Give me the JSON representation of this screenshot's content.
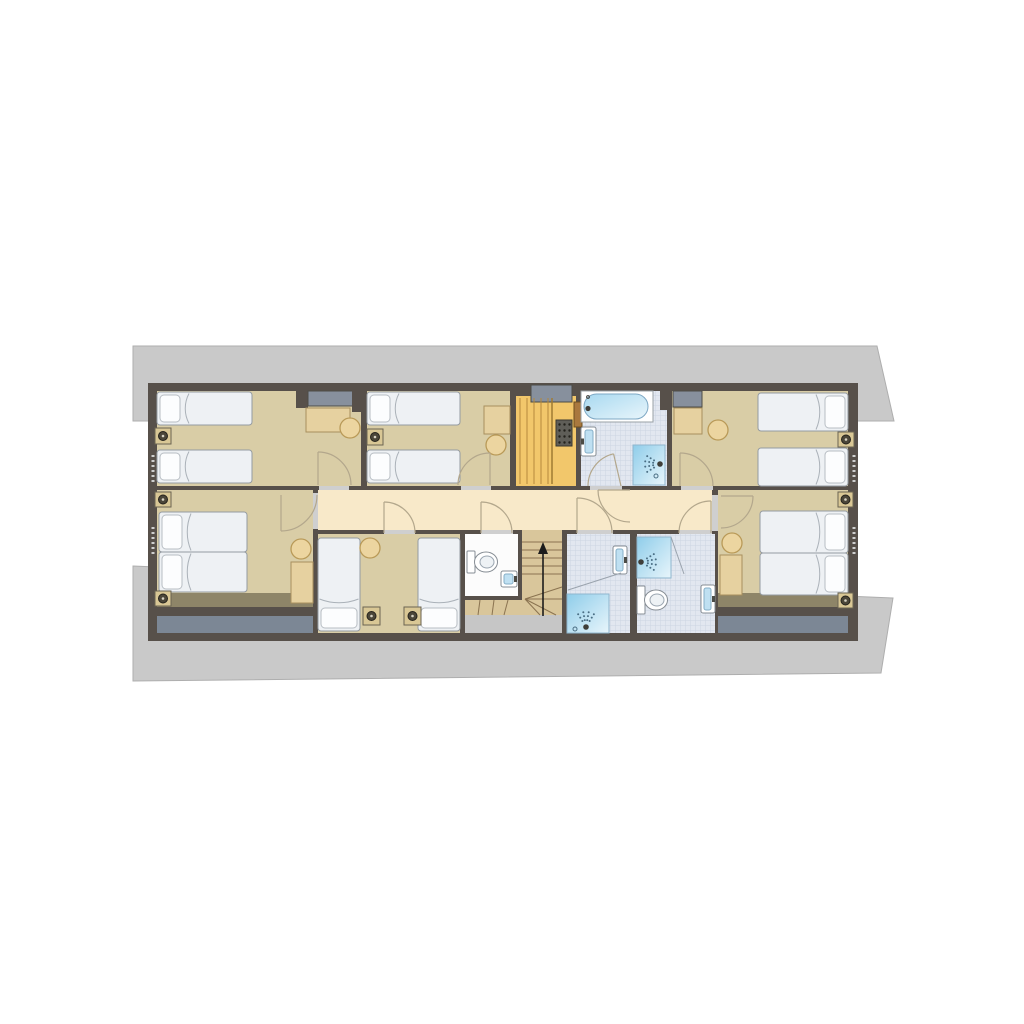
{
  "meta": {
    "kind": "architectural-floor-plan",
    "canvas_w": 1024,
    "canvas_h": 1024,
    "background": "#ffffff"
  },
  "palette": {
    "wall": "#57504a",
    "bedroom_floor": "#d9cda6",
    "corridor_floor": "#f8e9c9",
    "bath_tile_base": "#e2e7f0",
    "bath_tile_line": "#ccd4e2",
    "sauna": "#f2c76b",
    "stair_wood": "#d9c69b",
    "stair_line": "#8a7350",
    "roof": "#c9c9c9",
    "eaves_slate": "#7c8795",
    "eaves_olive": "#8e8568",
    "door_arc": "#b3a78c",
    "shower_blue": "#8fcdea",
    "fixture_white": "#ffffff"
  },
  "elements": [
    {
      "n": "roof-outline-upper",
      "t": "poly",
      "pts": "133,346 877,346 894,421 133,421",
      "f": "#c9c9c9",
      "s": "#aeaeae"
    },
    {
      "n": "roof-outline-lower",
      "t": "poly",
      "pts": "133,566 893,598 881,673 133,681",
      "f": "#c9c9c9",
      "s": "#aeaeae"
    },
    {
      "n": "building-walls",
      "t": "rect",
      "x": 148,
      "y": 383,
      "w": 710,
      "h": 258,
      "f": "#57504a"
    },
    {
      "n": "bedroom-1-floor",
      "t": "rect",
      "x": 157,
      "y": 391,
      "w": 204,
      "h": 95,
      "f": "#d9cda6"
    },
    {
      "n": "bedroom-2-floor",
      "t": "rect",
      "x": 367,
      "y": 391,
      "w": 143,
      "h": 95,
      "f": "#d9cda6"
    },
    {
      "n": "sauna-floor",
      "t": "rect",
      "x": 516,
      "y": 396,
      "w": 60,
      "h": 90,
      "f": "#f2c76b"
    },
    {
      "n": "bathroom-top-floor",
      "t": "rect",
      "x": 581,
      "y": 391,
      "w": 86,
      "h": 95,
      "f": "tile"
    },
    {
      "n": "bedroom-3-floor",
      "t": "rect",
      "x": 672,
      "y": 391,
      "w": 176,
      "h": 95,
      "f": "#d9cda6"
    },
    {
      "n": "corridor-floor",
      "t": "rect",
      "x": 318,
      "y": 490,
      "w": 394,
      "h": 40,
      "f": "#f8e9c9"
    },
    {
      "n": "bedroom-4-floor",
      "t": "rect",
      "x": 157,
      "y": 490,
      "w": 156,
      "h": 103,
      "f": "#d9cda6"
    },
    {
      "n": "eaves-olive-left",
      "t": "rect",
      "x": 157,
      "y": 593,
      "w": 156,
      "h": 14,
      "f": "#8e8568"
    },
    {
      "n": "eaves-slate-left",
      "t": "rect",
      "x": 157,
      "y": 616,
      "w": 156,
      "h": 17,
      "f": "#7c8795"
    },
    {
      "n": "bedroom-5-floor",
      "t": "rect",
      "x": 318,
      "y": 534,
      "w": 142,
      "h": 99,
      "f": "#d9cda6"
    },
    {
      "n": "wc-floor",
      "t": "rect",
      "x": 465,
      "y": 534,
      "w": 53,
      "h": 62,
      "f": "#fcfcfc"
    },
    {
      "n": "stair-flight",
      "t": "rect",
      "x": 522,
      "y": 534,
      "w": 40,
      "h": 66,
      "f": "#d9c69b"
    },
    {
      "n": "stair-winders",
      "t": "poly",
      "pts": "522,583 562,583 562,615 465,615 465,600 522,600",
      "f": "#d9c69b"
    },
    {
      "n": "under-stair-void",
      "t": "rect",
      "x": 465,
      "y": 615,
      "w": 97,
      "h": 18,
      "f": "#c6c6c6"
    },
    {
      "n": "bathroom-left-floor",
      "t": "rect",
      "x": 567,
      "y": 534,
      "w": 63,
      "h": 99,
      "f": "tile"
    },
    {
      "n": "bathroom-right-floor",
      "t": "rect",
      "x": 637,
      "y": 534,
      "w": 78,
      "h": 99,
      "f": "tile"
    },
    {
      "n": "bedroom-6-floor",
      "t": "rect",
      "x": 718,
      "y": 490,
      "w": 130,
      "h": 103,
      "f": "#d9cda6"
    },
    {
      "n": "eaves-olive-right",
      "t": "rect",
      "x": 718,
      "y": 593,
      "w": 130,
      "h": 14,
      "f": "#8e8568"
    },
    {
      "n": "eaves-slate-right",
      "t": "rect",
      "x": 718,
      "y": 616,
      "w": 130,
      "h": 17,
      "f": "#7c8795"
    },
    {
      "n": "wall-stub-a",
      "t": "rect",
      "x": 296,
      "y": 383,
      "w": 12,
      "h": 25,
      "f": "#57504a"
    },
    {
      "n": "duct-bedroom-1",
      "t": "rect",
      "x": 308,
      "y": 391,
      "w": 48,
      "h": 15,
      "f": "#87909d",
      "s": "#4c4c46"
    },
    {
      "n": "wall-stub-b",
      "t": "rect",
      "x": 352,
      "y": 383,
      "w": 14,
      "h": 29,
      "f": "#57504a"
    },
    {
      "n": "duct-sauna",
      "t": "rect",
      "x": 531,
      "y": 385,
      "w": 41,
      "h": 17,
      "f": "#87909d",
      "s": "#4c4c46"
    },
    {
      "n": "wall-stub-c",
      "t": "rect",
      "x": 660,
      "y": 383,
      "w": 12,
      "h": 27,
      "f": "#57504a"
    },
    {
      "n": "duct-bedroom-3",
      "t": "rect",
      "x": 673,
      "y": 391,
      "w": 29,
      "h": 16,
      "f": "#87909d",
      "s": "#4c4c46"
    },
    {
      "n": "threshold-bedroom-1",
      "t": "rect",
      "x": 319,
      "y": 486,
      "w": 30,
      "h": 4,
      "f": "#cfcfcf"
    },
    {
      "n": "threshold-bedroom-2",
      "t": "rect",
      "x": 461,
      "y": 486,
      "w": 30,
      "h": 4,
      "f": "#cfcfcf"
    },
    {
      "n": "threshold-bathroom-top",
      "t": "rect",
      "x": 590,
      "y": 486,
      "w": 32,
      "h": 4,
      "f": "#cfcfcf"
    },
    {
      "n": "threshold-bedroom-3",
      "t": "rect",
      "x": 681,
      "y": 486,
      "w": 32,
      "h": 4,
      "f": "#cfcfcf"
    },
    {
      "n": "threshold-bedroom-4",
      "t": "rect",
      "x": 313,
      "y": 493,
      "w": 5,
      "h": 36,
      "f": "#cfcfcf"
    },
    {
      "n": "threshold-bedroom-5",
      "t": "rect",
      "x": 384,
      "y": 530,
      "w": 31,
      "h": 4,
      "f": "#cfcfcf"
    },
    {
      "n": "threshold-wc",
      "t": "rect",
      "x": 481,
      "y": 530,
      "w": 32,
      "h": 4,
      "f": "#cfcfcf"
    },
    {
      "n": "threshold-bathroom-left",
      "t": "rect",
      "x": 577,
      "y": 530,
      "w": 36,
      "h": 4,
      "f": "#cfcfcf"
    },
    {
      "n": "threshold-bathroom-right",
      "t": "rect",
      "x": 679,
      "y": 530,
      "w": 33,
      "h": 4,
      "f": "#cfcfcf"
    },
    {
      "n": "threshold-bedroom-6",
      "t": "rect",
      "x": 712,
      "y": 495,
      "w": 6,
      "h": 36,
      "f": "#cfcfcf"
    },
    {
      "n": "threshold-stairs",
      "t": "rect",
      "x": 522,
      "y": 530,
      "w": 40,
      "h": 4,
      "f": "#d9c69b"
    },
    {
      "n": "sauna-bench-slat",
      "t": "line",
      "x1": 520,
      "y1": 398,
      "x2": 520,
      "y2": 484,
      "s": "#b5893c",
      "w": 1
    },
    {
      "n": "sauna-bench-slat",
      "t": "line",
      "x1": 527,
      "y1": 398,
      "x2": 527,
      "y2": 484,
      "s": "#b5893c",
      "w": 1
    },
    {
      "n": "sauna-bench-slat",
      "t": "line",
      "x1": 534,
      "y1": 398,
      "x2": 534,
      "y2": 484,
      "s": "#b5893c",
      "w": 1
    },
    {
      "n": "sauna-bench-slat",
      "t": "line",
      "x1": 541,
      "y1": 398,
      "x2": 541,
      "y2": 484,
      "s": "#b5893c",
      "w": 1
    },
    {
      "n": "sauna-bench-slat",
      "t": "line",
      "x1": 548,
      "y1": 398,
      "x2": 548,
      "y2": 484,
      "s": "#b5893c",
      "w": 1
    },
    {
      "n": "sauna-bench-edge",
      "t": "line",
      "x1": 552,
      "y1": 398,
      "x2": 552,
      "y2": 484,
      "s": "#a07a33",
      "w": 1.5
    },
    {
      "n": "sauna-heater",
      "t": "rect",
      "x": 556,
      "y": 420,
      "w": 16,
      "h": 26,
      "f": "#5f5e58",
      "s": "#38372f"
    },
    {
      "n": "sauna-heater-stones",
      "t": "dotgrid",
      "x": 559.5,
      "y": 424.5,
      "cols": 3,
      "rows": 4,
      "dx": 5,
      "dy": 6,
      "r": 1.2,
      "f": "#23221c"
    },
    {
      "n": "sauna-door",
      "t": "rect",
      "x": 574,
      "y": 402,
      "w": 8,
      "h": 25,
      "f": "#a9783e",
      "s": "#70501f"
    },
    {
      "n": "stair-tread",
      "t": "line",
      "x1": 522,
      "y1": 542,
      "x2": 562,
      "y2": 542,
      "s": "#8a7350",
      "w": 1
    },
    {
      "n": "stair-tread",
      "t": "line",
      "x1": 522,
      "y1": 550,
      "x2": 562,
      "y2": 550,
      "s": "#8a7350",
      "w": 1
    },
    {
      "n": "stair-tread",
      "t": "line",
      "x1": 522,
      "y1": 558,
      "x2": 562,
      "y2": 558,
      "s": "#8a7350",
      "w": 1
    },
    {
      "n": "stair-tread",
      "t": "line",
      "x1": 522,
      "y1": 566,
      "x2": 562,
      "y2": 566,
      "s": "#8a7350",
      "w": 1
    },
    {
      "n": "stair-tread",
      "t": "line",
      "x1": 522,
      "y1": 574,
      "x2": 562,
      "y2": 574,
      "s": "#8a7350",
      "w": 1
    },
    {
      "n": "stair-winder-line",
      "t": "line",
      "x1": 525,
      "y1": 599,
      "x2": 562,
      "y2": 587,
      "s": "#8a7350",
      "w": 1
    },
    {
      "n": "stair-winder-line",
      "t": "line",
      "x1": 525,
      "y1": 599,
      "x2": 562,
      "y2": 599,
      "s": "#8a7350",
      "w": 1
    },
    {
      "n": "stair-winder-line",
      "t": "line",
      "x1": 525,
      "y1": 599,
      "x2": 556,
      "y2": 615,
      "s": "#8a7350",
      "w": 1
    },
    {
      "n": "stair-winder-line",
      "t": "line",
      "x1": 525,
      "y1": 599,
      "x2": 540,
      "y2": 615,
      "s": "#8a7350",
      "w": 1
    },
    {
      "n": "stair-winder-line",
      "t": "line",
      "x1": 508,
      "y1": 600,
      "x2": 504,
      "y2": 615,
      "s": "#8a7350",
      "w": 1
    },
    {
      "n": "stair-winder-line",
      "t": "line",
      "x1": 494,
      "y1": 600,
      "x2": 492,
      "y2": 615,
      "s": "#8a7350",
      "w": 1
    },
    {
      "n": "stair-winder-line",
      "t": "line",
      "x1": 480,
      "y1": 600,
      "x2": 478,
      "y2": 615,
      "s": "#8a7350",
      "w": 1
    },
    {
      "n": "stair-up-arrow-shaft",
      "t": "line",
      "x1": 543,
      "y1": 616,
      "x2": 543,
      "y2": 552,
      "s": "#1c1c1c",
      "w": 1.6
    },
    {
      "n": "stair-up-arrow-head",
      "t": "poly",
      "pts": "543,542 538,554 548,554",
      "f": "#1c1c1c"
    },
    {
      "n": "bathtub",
      "t": "tub",
      "x": 581,
      "y": 391,
      "w": 72,
      "h": 31
    },
    {
      "n": "sink-bathroom-top",
      "t": "sink",
      "x": 581,
      "y": 427,
      "w": 15,
      "h": 29,
      "side": "left"
    },
    {
      "n": "shower-bathroom-top",
      "t": "shower",
      "x": 633,
      "y": 445,
      "w": 32,
      "h": 40,
      "hx": 660,
      "hy": 464,
      "dx": -1,
      "dy": 0
    },
    {
      "n": "drain-bathroom-top",
      "t": "circle",
      "cx": 656,
      "cy": 476,
      "r": 2,
      "f": "none",
      "s": "#4a6e84"
    },
    {
      "n": "sink-bathroom-left",
      "t": "sink",
      "x": 613,
      "y": 546,
      "w": 14,
      "h": 28,
      "side": "right"
    },
    {
      "n": "shower-bathroom-left",
      "t": "shower",
      "x": 567,
      "y": 594,
      "w": 42,
      "h": 39,
      "hx": 586,
      "hy": 627,
      "dx": 0,
      "dy": -1
    },
    {
      "n": "headroom-line-left",
      "t": "line",
      "x1": 568,
      "y1": 590,
      "x2": 621,
      "y2": 573,
      "s": "#9aa3ad",
      "w": 1
    },
    {
      "n": "drain-bathroom-left",
      "t": "circle",
      "cx": 575,
      "cy": 629,
      "r": 2,
      "f": "none",
      "s": "#4a6e84"
    },
    {
      "n": "shower-bathroom-right",
      "t": "shower",
      "x": 637,
      "y": 537,
      "w": 34,
      "h": 41,
      "hx": 641,
      "hy": 562,
      "dx": 1,
      "dy": 0
    },
    {
      "n": "headroom-line-right",
      "t": "line",
      "x1": 671,
      "y1": 537,
      "x2": 684,
      "y2": 574,
      "s": "#9aa3ad",
      "w": 1
    },
    {
      "n": "toilet-bathroom-right",
      "t": "toilet",
      "x": 637,
      "y": 586,
      "th": 28
    },
    {
      "n": "sink-bathroom-right",
      "t": "sink",
      "x": 701,
      "y": 585,
      "w": 14,
      "h": 28,
      "side": "right"
    },
    {
      "n": "toilet-wc",
      "t": "toilet",
      "x": 467,
      "y": 551,
      "th": 22
    },
    {
      "n": "sink-wc",
      "t": "sink",
      "x": 501,
      "y": 571,
      "w": 16,
      "h": 16,
      "side": "right"
    },
    {
      "n": "desk-bedroom-1",
      "t": "rect",
      "x": 306,
      "y": 408,
      "w": 44,
      "h": 24,
      "f": "#e6d1a0",
      "s": "#a8905e"
    },
    {
      "n": "desk-bedroom-2",
      "t": "rect",
      "x": 484,
      "y": 406,
      "w": 26,
      "h": 28,
      "f": "#e6d1a0",
      "s": "#a8905e"
    },
    {
      "n": "desk-bedroom-3",
      "t": "rect",
      "x": 674,
      "y": 408,
      "w": 28,
      "h": 26,
      "f": "#e6d1a0",
      "s": "#a8905e"
    },
    {
      "n": "desk-bedroom-4",
      "t": "rect",
      "x": 291,
      "y": 562,
      "w": 22,
      "h": 41,
      "f": "#e6d1a0",
      "s": "#a8905e"
    },
    {
      "n": "desk-bedroom-6",
      "t": "rect",
      "x": 720,
      "y": 555,
      "w": 22,
      "h": 40,
      "f": "#e6d1a0",
      "s": "#a8905e"
    },
    {
      "n": "bed-single",
      "t": "bed",
      "x": 157,
      "y": 392,
      "w": 95,
      "h": 33,
      "dir": "left"
    },
    {
      "n": "bed-single",
      "t": "bed",
      "x": 157,
      "y": 450,
      "w": 95,
      "h": 33,
      "dir": "left"
    },
    {
      "n": "bed-single",
      "t": "bed",
      "x": 367,
      "y": 392,
      "w": 93,
      "h": 33,
      "dir": "left"
    },
    {
      "n": "bed-single",
      "t": "bed",
      "x": 367,
      "y": 450,
      "w": 93,
      "h": 33,
      "dir": "left"
    },
    {
      "n": "bed-single",
      "t": "bed",
      "x": 758,
      "y": 393,
      "w": 90,
      "h": 38,
      "dir": "right"
    },
    {
      "n": "bed-single",
      "t": "bed",
      "x": 758,
      "y": 448,
      "w": 90,
      "h": 38,
      "dir": "right"
    },
    {
      "n": "bed-double-half",
      "t": "bed",
      "x": 159,
      "y": 512,
      "w": 88,
      "h": 40,
      "dir": "left"
    },
    {
      "n": "bed-double-half",
      "t": "bed",
      "x": 159,
      "y": 552,
      "w": 88,
      "h": 40,
      "dir": "left"
    },
    {
      "n": "bed-single",
      "t": "bed",
      "x": 318,
      "y": 538,
      "w": 42,
      "h": 93,
      "dir": "bottom"
    },
    {
      "n": "bed-single",
      "t": "bed",
      "x": 418,
      "y": 538,
      "w": 42,
      "h": 93,
      "dir": "bottom"
    },
    {
      "n": "bed-double-half",
      "t": "bed",
      "x": 760,
      "y": 511,
      "w": 88,
      "h": 42,
      "dir": "right"
    },
    {
      "n": "bed-double-half",
      "t": "bed",
      "x": 760,
      "y": 553,
      "w": 88,
      "h": 42,
      "dir": "right"
    },
    {
      "n": "nightstand",
      "t": "stand",
      "x": 155,
      "y": 428,
      "w": 16,
      "h": 16
    },
    {
      "n": "nightstand",
      "t": "stand",
      "x": 367,
      "y": 429,
      "w": 16,
      "h": 16
    },
    {
      "n": "nightstand",
      "t": "stand",
      "x": 838,
      "y": 432,
      "w": 16,
      "h": 15
    },
    {
      "n": "nightstand",
      "t": "stand",
      "x": 155,
      "y": 492,
      "w": 16,
      "h": 15
    },
    {
      "n": "nightstand",
      "t": "stand",
      "x": 155,
      "y": 591,
      "w": 16,
      "h": 15
    },
    {
      "n": "nightstand",
      "t": "stand",
      "x": 363,
      "y": 607,
      "w": 17,
      "h": 18
    },
    {
      "n": "nightstand",
      "t": "stand",
      "x": 404,
      "y": 607,
      "w": 17,
      "h": 18
    },
    {
      "n": "nightstand",
      "t": "stand",
      "x": 838,
      "y": 492,
      "w": 15,
      "h": 15
    },
    {
      "n": "nightstand",
      "t": "stand",
      "x": 838,
      "y": 593,
      "w": 15,
      "h": 15
    },
    {
      "n": "stool",
      "t": "stool",
      "cx": 350,
      "cy": 428,
      "r": 10
    },
    {
      "n": "stool",
      "t": "stool",
      "cx": 496,
      "cy": 445,
      "r": 10
    },
    {
      "n": "stool",
      "t": "stool",
      "cx": 718,
      "cy": 430,
      "r": 10
    },
    {
      "n": "stool",
      "t": "stool",
      "cx": 301,
      "cy": 549,
      "r": 10
    },
    {
      "n": "stool",
      "t": "stool",
      "cx": 370,
      "cy": 548,
      "r": 10
    },
    {
      "n": "stool",
      "t": "stool",
      "cx": 732,
      "cy": 543,
      "r": 10
    },
    {
      "n": "door-bedroom-1",
      "t": "door",
      "hx": 318,
      "hy": 485,
      "r": 33,
      "a1": -90,
      "a2": 0
    },
    {
      "n": "door-bedroom-2",
      "t": "door",
      "hx": 490,
      "hy": 485,
      "r": 32,
      "a1": -90,
      "a2": -180
    },
    {
      "n": "door-bedroom-4",
      "t": "door",
      "hx": 281,
      "hy": 495,
      "r": 36,
      "a1": 90,
      "a2": 0
    },
    {
      "n": "door-bedroom-5",
      "t": "door",
      "hx": 384,
      "hy": 533,
      "r": 31,
      "a1": -90,
      "a2": 0
    },
    {
      "n": "door-wc",
      "t": "door",
      "hx": 481,
      "hy": 533,
      "r": 31,
      "a1": -90,
      "a2": 0
    },
    {
      "n": "door-bathroom-left",
      "t": "door",
      "hx": 577,
      "hy": 533,
      "r": 35,
      "a1": -90,
      "a2": 0
    },
    {
      "n": "door-corridor-bathroom-top",
      "t": "door",
      "hx": 630,
      "hy": 490,
      "r": 32,
      "a1": 180,
      "a2": 90
    },
    {
      "n": "door-bathroom-top",
      "t": "door",
      "hx": 621,
      "hy": 486,
      "r": 33,
      "a1": -103,
      "a2": -180
    },
    {
      "n": "door-bathroom-right",
      "t": "door",
      "hx": 711,
      "hy": 533,
      "r": 32,
      "a1": -90,
      "a2": -180
    },
    {
      "n": "door-bedroom-3",
      "t": "door",
      "hx": 680,
      "hy": 486,
      "r": 33,
      "a1": -90,
      "a2": 0
    },
    {
      "n": "door-bedroom-6",
      "t": "door",
      "hx": 721,
      "hy": 496,
      "r": 32,
      "a1": 0,
      "a2": 90
    },
    {
      "n": "wall-vent",
      "t": "line",
      "x1": 153,
      "y1": 455,
      "x2": 153,
      "y2": 485,
      "s": "#cfcfcf",
      "w": 3,
      "dash": "2 3"
    },
    {
      "n": "wall-vent",
      "t": "line",
      "x1": 153,
      "y1": 527,
      "x2": 153,
      "y2": 557,
      "s": "#cfcfcf",
      "w": 3,
      "dash": "2 3"
    },
    {
      "n": "wall-vent",
      "t": "line",
      "x1": 854,
      "y1": 455,
      "x2": 854,
      "y2": 485,
      "s": "#cfcfcf",
      "w": 3,
      "dash": "2 3"
    },
    {
      "n": "wall-vent",
      "t": "line",
      "x1": 854,
      "y1": 527,
      "x2": 854,
      "y2": 557,
      "s": "#cfcfcf",
      "w": 3,
      "dash": "2 3"
    }
  ]
}
